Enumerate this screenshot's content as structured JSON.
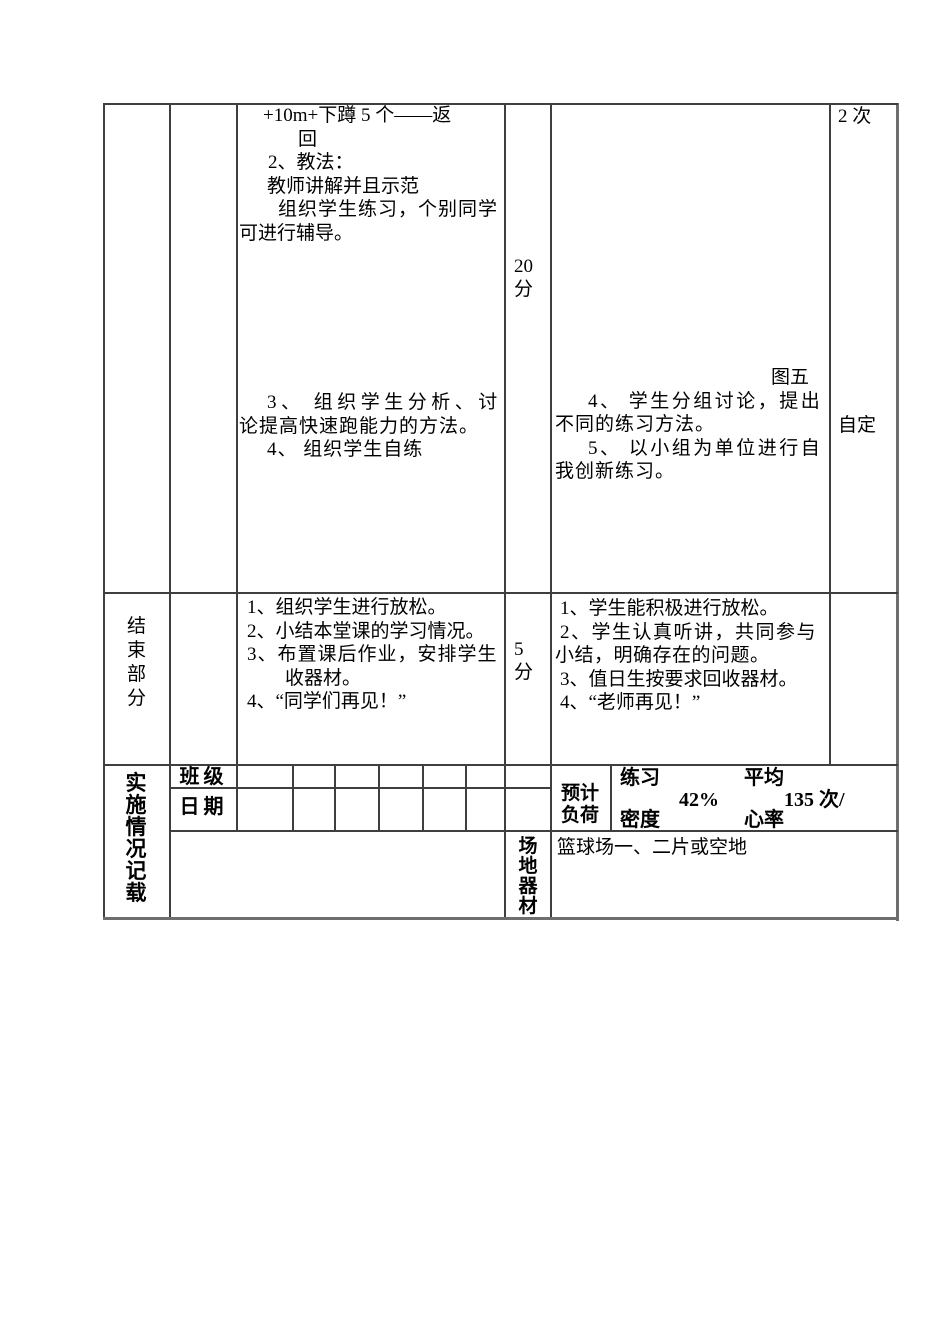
{
  "page": {
    "background": "#ffffff",
    "grid_color": "#3f3f3f",
    "outer_border_color": "#6e6e6e",
    "text_color": "#000000"
  },
  "main_section": {
    "teacher_lines": [
      {
        "text": "+10m+下蹲 5 个——返",
        "ml": 24
      },
      {
        "text": "回",
        "ml": 59
      },
      {
        "text": "2、教法：",
        "ml": 29
      },
      {
        "text": "教师讲解并且示范",
        "ml": 28
      },
      {
        "text": "组织学生练习，个别同学",
        "ml": 39,
        "ls": 1
      },
      {
        "text": "可进行辅导。",
        "ml": 0
      },
      {
        "text": "3、 组织学生分析、讨",
        "ml": 28,
        "ls": 4.5,
        "mt": 146
      },
      {
        "text": "论提高快速跑能力的方法。",
        "ml": 0,
        "ls": 1
      },
      {
        "text": "4、 组织学生自练",
        "ml": 28,
        "ls": 1
      }
    ],
    "time_lines": [
      {
        "text": "20"
      },
      {
        "text": "分"
      }
    ],
    "reps_top": "2 次",
    "reps_self": "自定",
    "student_lines": [
      {
        "text": "图五",
        "ml": 216
      },
      {
        "text": "4、 学生分组讨论，提出",
        "ml": 33,
        "ls": 2.5
      },
      {
        "text": "不同的练习方法。",
        "ml": 0,
        "ls": 1
      },
      {
        "text": "5、 以小组为单位进行自",
        "ml": 33,
        "ls": 2.5
      },
      {
        "text": "我创新练习。",
        "ml": 0,
        "ls": 1
      }
    ]
  },
  "closing_section": {
    "part_label": "结\n束\n部\n分",
    "teacher_lines": [
      {
        "text": "1、组织学生进行放松。",
        "ml": 8
      },
      {
        "text": "2、小结本堂课的学习情况。",
        "ml": 8
      },
      {
        "text": "3、布置课后作业，安排学生",
        "ml": 8,
        "ls": 1
      },
      {
        "text": "收器材。",
        "ml": 46
      },
      {
        "text": "4、“同学们再见！”",
        "ml": 8
      }
    ],
    "time_lines": [
      {
        "text": "5"
      },
      {
        "text": "分"
      }
    ],
    "student_lines": [
      {
        "text": "1、学生能积极进行放松。",
        "ml": 5
      },
      {
        "text": "2、学生认真听讲，共同参与",
        "ml": 5,
        "ls": 1.5
      },
      {
        "text": "小结，明确存在的问题。",
        "ml": 0,
        "ls": 0.5
      },
      {
        "text": "3、值日生按要求回收器材。",
        "ml": 5
      },
      {
        "text": "4、“老师再见！”",
        "ml": 5
      }
    ]
  },
  "record_section": {
    "label": "实\n施\n情\n况\n记\n载",
    "class_label": "班级",
    "date_label": "日期",
    "load": {
      "label": "预计\n负荷",
      "practice_top": "练习",
      "practice_value": "42%",
      "practice_bottom": "密度",
      "heart_top": "平均",
      "heart_value": "135 次/",
      "heart_bottom": "心率"
    },
    "venue": {
      "label": "场\n地\n器\n材",
      "text": "篮球场一、二片或空地"
    }
  }
}
